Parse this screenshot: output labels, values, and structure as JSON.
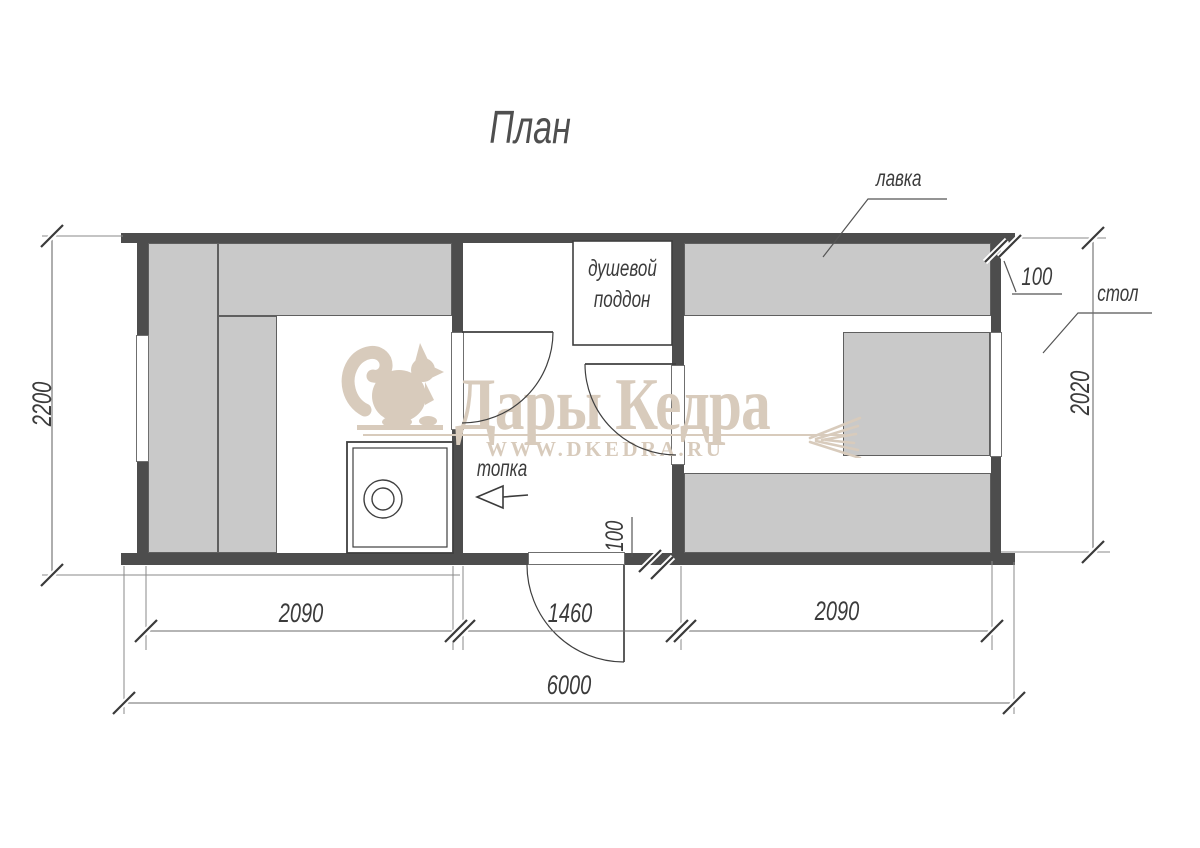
{
  "title": "План",
  "watermark": {
    "brand": "Дары Кедра",
    "site": "WWW.DKEDRA.RU"
  },
  "labels": {
    "bench": "лавка",
    "table": "стол",
    "firebox": "топка",
    "shower_tray_line1": "душевой",
    "shower_tray_line2": "поддон"
  },
  "dimensions": {
    "total_width": "6000",
    "total_depth": "2200",
    "steam_room_width": "2090",
    "washroom_width": "1460",
    "rest_room_width": "2090",
    "rest_room_depth": "2020",
    "wall_thickness_right": "100",
    "wall_thickness_middle": "100"
  },
  "colors": {
    "wall": "#4d4d4d",
    "furniture": "#c9c9c9",
    "line": "#3f3f3f",
    "watermark": "#d8cbbc"
  }
}
